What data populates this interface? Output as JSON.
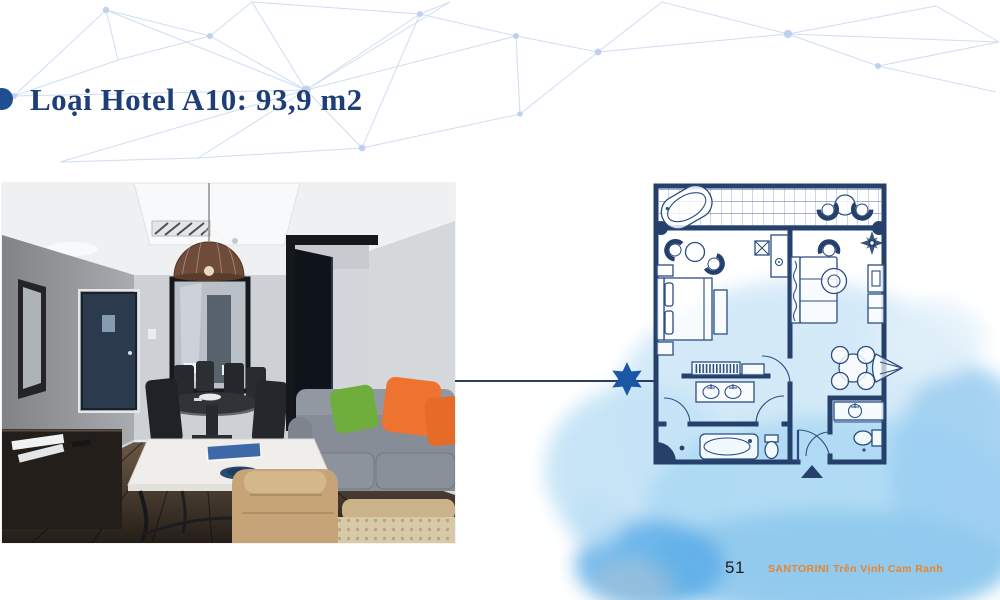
{
  "slide": {
    "title": "Loại Hotel A10: 93,9 m2",
    "colors": {
      "title_navy": "#1d3e77",
      "plan_wall_navy": "#24406b",
      "star_blue": "#1c57a5",
      "watercolor_blue": "#8fc9ee",
      "mesh_blue": "#c3d4ee",
      "brand_orange": "#e8842c",
      "pillow_green": "#6fae3c",
      "pillow_orange": "#ee7330"
    }
  },
  "photo": {
    "alt": "Hotel suite living room photo: dark wood floor, grey sofa with green and orange pillows, white coffee table, dining table, mirror, pendant lamp, dark blue entry door"
  },
  "floor_plan": {
    "alt": "Floor plan of Hotel A10 apartment: balcony with bathtub and chairs, bedroom, living room, two bathrooms, entry arrow",
    "marker_icon": "six-pointed-star"
  },
  "footer": {
    "page": "51",
    "brand": "SANTORINI",
    "tagline": "Trên Vịnh Cam Ranh"
  }
}
